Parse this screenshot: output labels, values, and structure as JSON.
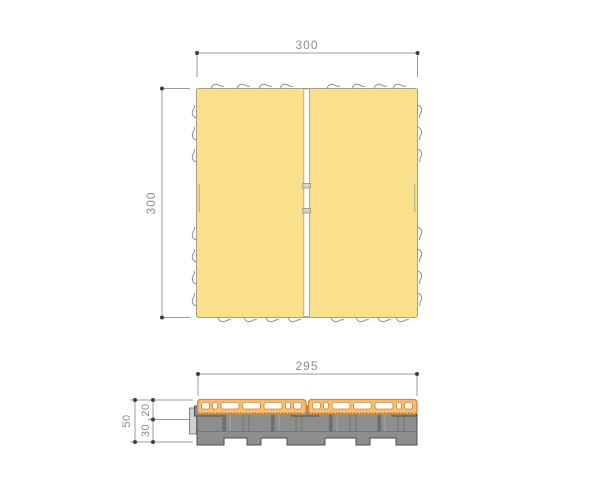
{
  "drawing": {
    "type": "technical-drawing",
    "subject": "interlocking deck tile - plan view and cross-section",
    "views": {
      "top": {
        "width_dim": "300",
        "height_dim": "300"
      },
      "section": {
        "width_dim": "295",
        "total_height_dim": "50",
        "deck_board_dim": "20",
        "base_dim": "30"
      }
    },
    "colors": {
      "background": "#FFFFFF",
      "tile_fill": "#FBE08C",
      "tile_outline": "#A89F86",
      "board_fill": "#F6BE74",
      "board_outline": "#D98A2E",
      "slot_fill": "#FFFFFF",
      "base_fill": "#8E8E8E",
      "base_outline": "#4D4D4D",
      "clip_fill": "#8A8A8A",
      "dim_line": "#9B9B9B",
      "dim_text": "#8C8C8C"
    }
  }
}
